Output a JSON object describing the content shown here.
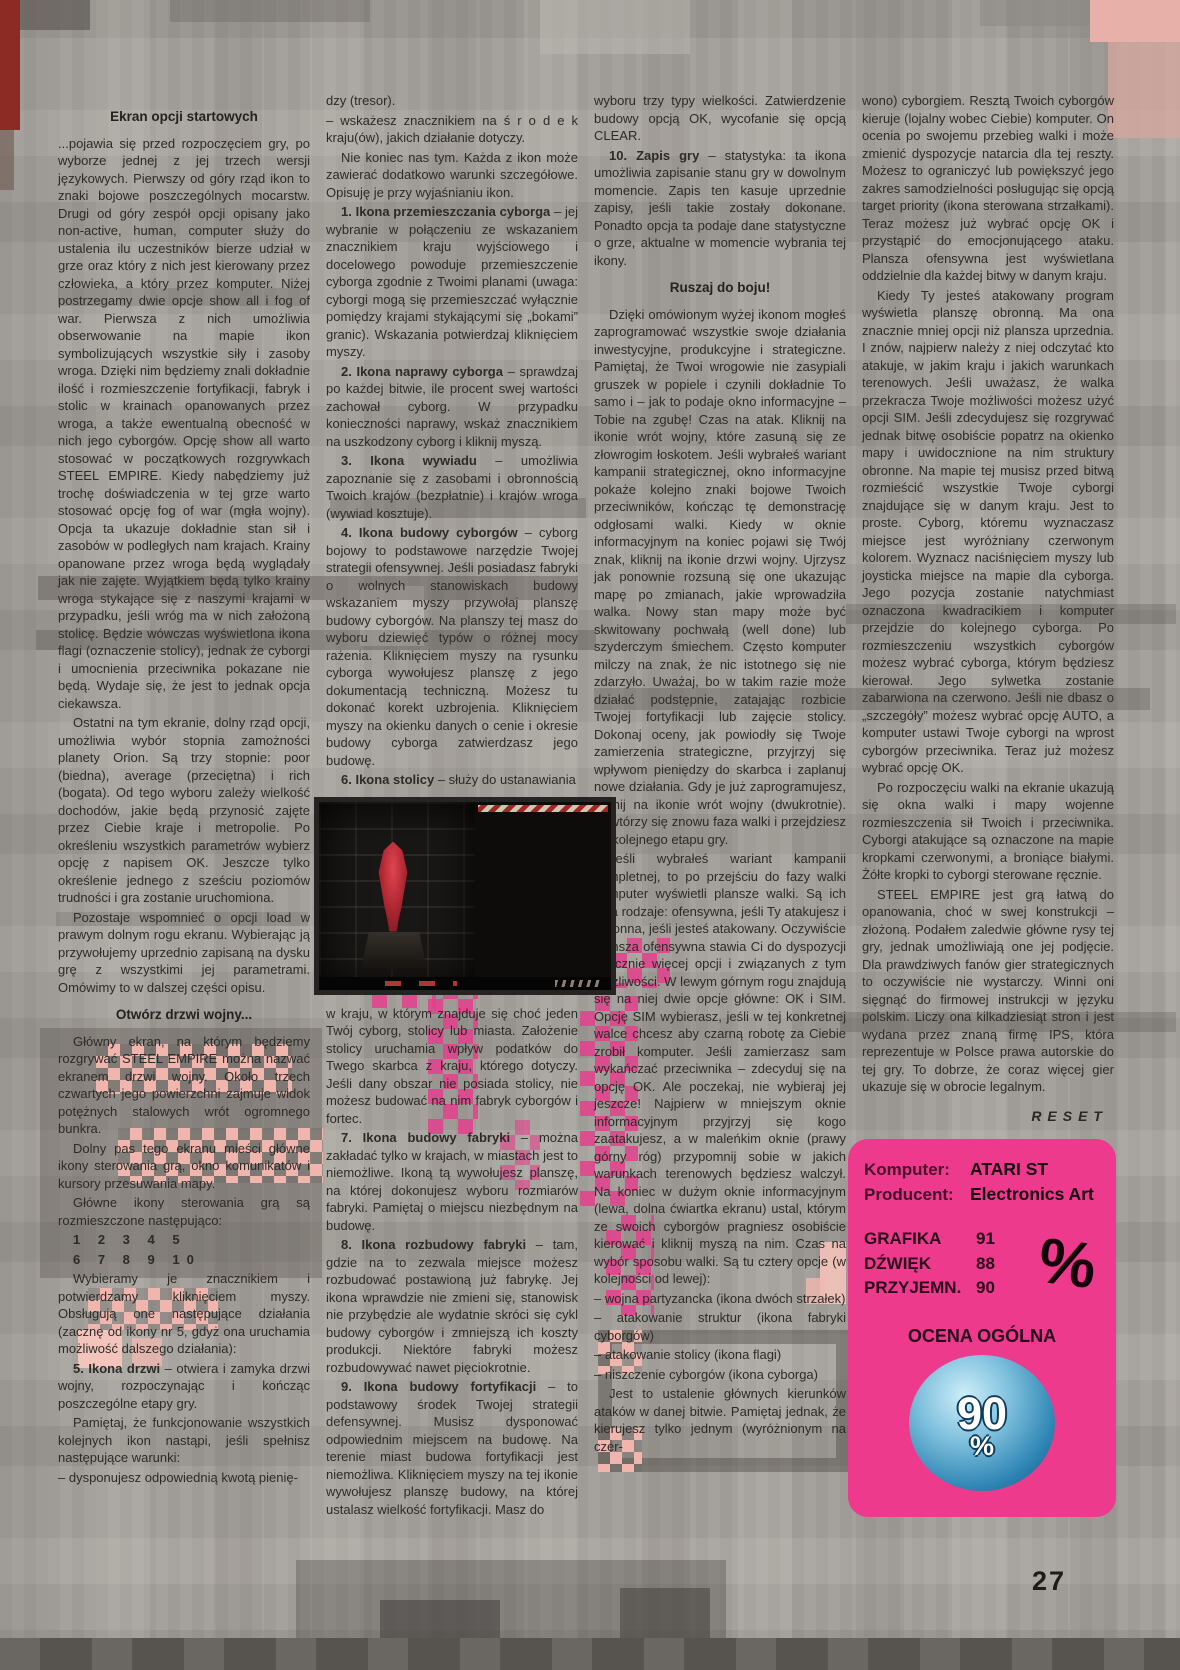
{
  "page": {
    "number": "27"
  },
  "cols": {
    "c1": {
      "heading1": "Ekran opcji startowych",
      "heading2": "Otwórz drzwi wojny...",
      "paras": [
        "...pojawia się przed rozpoczęciem gry, po wyborze jednej z jej trzech wersji językowych. Pierwszy od góry rząd ikon to znaki bojowe poszczególnych mocarstw. Drugi od góry zespół opcji opisany jako non-active, human, computer służy do ustalenia ilu uczestników bierze udział w grze oraz który z nich jest kierowany przez człowieka, a który przez komputer. Niżej postrzegamy dwie opcje show all i fog of war. Pierwsza z nich umożliwia obserwowanie na mapie ikon symbolizujących wszystkie siły i zasoby wroga. Dzięki nim będziemy znali dokładnie ilość i rozmieszczenie fortyfikacji, fabryk i stolic w krainach opanowanych przez wroga, a także ewentualną obecność w nich jego cyborgów. Opcję show all warto stosować w początkowych rozgrywkach STEEL EMPIRE. Kiedy nabędziemy już trochę doświadczenia w tej grze warto stosować opcję fog of war (mgła wojny). Opcja ta ukazuje dokładnie stan sił i zasobów w podległych nam krajach. Krainy opanowane przez wroga będą wyglądały jak nie zajęte. Wyjątkiem będą tylko krainy wroga stykające się z naszymi krajami w przypadku, jeśli wróg ma w nich założoną stolicę. Będzie wówczas wyświetlona ikona flagi (oznaczenie stolicy), jednak że cyborgi i umocnienia przeciwnika pokazane nie będą. Wydaje się, że jest to jednak opcja ciekawsza.",
        "Ostatni na tym ekranie, dolny rząd opcji, umożliwia wybór stopnia zamożności planety Orion. Są trzy stopnie: poor (biedna), average (przeciętna) i rich (bogata). Od tego wyboru zależy wielkość dochodów, jakie będą przynosić zajęte przez Ciebie kraje i metropolie. Po określeniu wszystkich parametrów wybierz opcję z napisem OK. Jeszcze tylko określenie jednego z sześciu poziomów trudności i gra zostanie uruchomiona.",
        "Pozostaje wspomnieć o opcji load w prawym dolnym rogu ekranu. Wybierając ją przywołujemy uprzednio zapisaną na dysku grę z wszystkimi jej parametrami. Omówimy to w dalszej części opisu.",
        "Główny ekran, na którym będziemy rozgrywać STEEL EMPIRE można nazwać ekranem drzwi wojny. Około trzech czwartych jego powierzchni zajmuje widok potężnych stalowych wrót ogromnego bunkra.",
        "Dolny pas tego ekranu mieści główne ikony sterowania grą, okno komunikatów i kursory przesuwania mapy.",
        "Główne ikony sterowania grą są rozmieszczone następująco:",
        "1 2 3 4 5",
        "6 7 8 9 10",
        "Wybieramy je znacznikiem i potwierdzamy kliknięciem myszy. Obsługują one następujące działania (zacznę od ikony nr 5, gdyż ona uruchamia możliwość dalszego działania):",
        {
          "lead": "5. Ikona drzwi",
          "rest": " – otwiera i zamyka drzwi wojny, rozpoczynając i kończąc poszczególne etapy gry."
        },
        "Pamiętaj, że funkcjonowanie wszystkich kolejnych ikon nastąpi, jeśli spełnisz następujące warunki:",
        "– dysponujesz odpowiednią kwotą pienię-"
      ]
    },
    "c2": {
      "paras": [
        "dzy (tresor).",
        "– wskażesz znacznikiem na ś r o d e k kraju(ów), jakich działanie dotyczy.",
        "Nie koniec nas tym. Każda z ikon może zawierać dodatkowo warunki szczegółowe. Opisuję je przy wyjaśnianiu ikon.",
        {
          "lead": "1. Ikona przemieszczania cyborga",
          "rest": " – jej wybranie w połączeniu ze wskazaniem znacznikiem kraju wyjściowego i docelowego powoduje przemieszczenie cyborga zgodnie z Twoimi planami (uwaga: cyborgi mogą się przemieszczać wyłącznie pomiędzy krajami stykającymi się „bokami” granic). Wskazania potwierdzaj kliknięciem myszy."
        },
        {
          "lead": "2. Ikona naprawy cyborga",
          "rest": " – sprawdzaj po każdej bitwie, ile procent swej wartości zachował cyborg. W przypadku konieczności naprawy, wskaż znacznikiem na uszkodzony cyborg i kliknij myszą."
        },
        {
          "lead": "3. Ikona wywiadu",
          "rest": " – umożliwia zapoznanie się z zasobami i obronnością Twoich krajów (bezpłatnie) i krajów wroga (wywiad kosztuje)."
        },
        {
          "lead": "4. Ikona budowy cyborgów",
          "rest": " – cyborg bojowy to podstawowe narzędzie Twojej strategii ofensywnej. Jeśli posiadasz fabryki o wolnych stanowiskach budowy wskazaniem myszy przywołaj planszę budowy cyborgów. Na planszy tej masz do wyboru dziewięć typów o różnej mocy rażenia. Kliknięciem myszy na rysunku cyborga wywołujesz planszę z jego dokumentacją techniczną. Możesz tu dokonać korekt uzbrojenia. Kliknięciem myszy na okienku danych o cenie i okresie budowy cyborga zatwierdzasz jego budowę."
        },
        {
          "lead": "6. Ikona stolicy",
          "rest": " – służy do ustanawiania"
        },
        "w kraju, w którym znajduje się choć jeden Twój cyborg, stolicy lub miasta. Założenie stolicy uruchamia wpływ podatków do Twego skarbca z kraju, którego dotyczy. Jeśli dany obszar nie posiada stolicy, nie możesz budować na nim fabryk cyborgów i fortec.",
        {
          "lead": "7. Ikona budowy fabryki",
          "rest": " – można zakładać tylko w krajach, w miastach jest to niemożliwe. Ikoną tą wywołujesz planszę, na której dokonujesz wyboru rozmiarów fabryki. Pamiętaj o miejscu niezbędnym na budowę."
        },
        {
          "lead": "8. Ikona rozbudowy fabryki",
          "rest": " – tam, gdzie na to zezwala miejsce możesz rozbudować postawioną już fabrykę. Jej ikona wprawdzie nie zmieni się, stanowisk nie przybędzie ale wydatnie skróci się cykl budowy cyborgów i zmniejszą ich koszty produkcji. Niektóre fabryki możesz rozbudowywać nawet pięciokrotnie."
        },
        {
          "lead": "9. Ikona budowy fortyfikacji",
          "rest": " – to podstawowy środek Twojej strategii defensywnej. Musisz dysponować odpowiednim miejscem na budowę. Na terenie miast budowa fortyfikacji jest niemożliwa. Kliknięciem myszy na tej ikonie wywołujesz planszę budowy, na której ustalasz wielkość fortyfikacji. Masz do"
        }
      ]
    },
    "c3": {
      "heading": "Ruszaj do boju!",
      "paras": [
        "wyboru trzy typy wielkości. Zatwierdzenie budowy opcją OK, wycofanie się opcją CLEAR.",
        {
          "lead": "10. Zapis gry",
          "rest": " – statystyka: ta ikona umożliwia zapisanie stanu gry w dowolnym momencie. Zapis ten kasuje uprzednie zapisy, jeśli takie zostały dokonane. Ponadto opcja ta podaje dane statystyczne o grze, aktualne w momencie wybrania tej ikony."
        },
        "Dzięki omówionym wyżej ikonom mogłeś zaprogramować wszystkie swoje działania inwestycyjne, produkcyjne i strategiczne. Pamiętaj, że Twoi wrogowie nie zasypiali gruszek w popiele i czynili dokładnie To samo i – jak to podaje okno informacyjne – Tobie na zgubę! Czas na atak. Kliknij na ikonie wrót wojny, które zasuną się ze złowrogim łoskotem. Jeśli wybrałeś wariant kampanii strategicznej, okno informacyjne pokaże kolejno znaki bojowe Twoich przeciwników, kończąc tę demonstrację odgłosami walki. Kiedy w oknie informacyjnym na koniec pojawi się Twój znak, kliknij na ikonie drzwi wojny. Ujrzysz jak ponownie rozsuną się one ukazując mapę po zmianach, jakie wprowadziła walka. Nowy stan mapy może być skwitowany pochwałą (well done) lub szyderczym śmiechem. Często komputer milczy na znak, że nic istotnego się nie zdarzyło. Uważaj, bo w takim razie może działać podstępnie, zatajając rozbicie Twojej fortyfikacji lub zajęcie stolicy. Dokonaj oceny, jak powiodły się Twoje zamierzenia strategiczne, przyjrzyj się wpływom pieniędzy do skarbca i zaplanuj nowe działania. Gdy je już zaprogramujesz, kliknij na ikonie wrót wojny (dwukrotnie). Powtórzy się znowu faza walki i przejdziesz do kolejnego etapu gry.",
        "Jeśli wybrałeś wariant kampanii kompletnej, to po przejściu do fazy walki komputer wyświetli plansze walki. Są ich dwa rodzaje: ofensywna, jeśli Ty atakujesz i obronna, jeśli jesteś atakowany. Oczywiście plansza ofensywna stawia Ci do dyspozycji znacznie więcej opcji i związanych z tym możliwości. W lewym górnym rogu znajdują się na niej dwie opcje główne: OK i SIM. Opcję SIM wybierasz, jeśli w tej konkretnej walce chcesz aby czarną robotę za Ciebie zrobił komputer. Jeśli zamierzasz sam wykańczać przeciwnika – zdecyduj się na opcję OK. Ale poczekaj, nie wybieraj jej jeszcze! Najpierw w mniejszym oknie informacyjnym przyjrzyj się kogo zaatakujesz, a w maleńkim oknie (prawy górny róg) przypomnij sobie w jakich warunkach terenowych będziesz walczył. Na koniec w dużym oknie informacyjnym (lewa, dolna ćwiartka ekranu) ustal, którym ze swoich cyborgów pragniesz osobiście kierować i kliknij myszą na nim. Czas na wybór sposobu walki. Są tu cztery opcje (w kolejności od lewej):",
        "– wojna partyzancka (ikona dwóch strzałek)",
        "– atakowanie struktur (ikona fabryki cyborgów)",
        "– atakowanie stolicy (ikona flagi)",
        "– niszczenie cyborgów (ikona cyborga)",
        "Jest to ustalenie głównych kierunków ataków w danej bitwie. Pamiętaj jednak, że kierujesz tylko jednym (wyróżnionym na czer-"
      ]
    },
    "c4": {
      "signature": "RESET",
      "paras": [
        "wono) cyborgiem. Resztą Twoich cyborgów kieruje (lojalny wobec Ciebie) komputer. On ocenia po swojemu przebieg walki i może zmienić dyspozycje natarcia dla tej reszty. Możesz to ograniczyć lub powiększyć jego zakres samodzielności posługując się opcją target priority (ikona sterowana strzałkami). Teraz możesz już wybrać opcję OK i przystąpić do emocjonującego ataku. Plansza ofensywna jest wyświetlana oddzielnie dla każdej bitwy w danym kraju.",
        "Kiedy Ty jesteś atakowany program wyświetla planszę obronną. Ma ona znacznie mniej opcji niż plansza uprzednia. I znów, najpierw należy z niej odczytać kto atakuje, w jakim kraju i jakich warunkach terenowych. Jeśli uważasz, że walka przekracza Twoje możliwości możesz użyć opcji SIM. Jeśli zdecydujesz się rozgrywać jednak bitwę osobiście popatrz na okienko mapy i uwidocznione na nim struktury obronne. Na mapie tej musisz przed bitwą rozmieścić wszystkie Twoje cyborgi znajdujące się w danym kraju. Jest to proste. Cyborg, któremu wyznaczasz miejsce jest wyróżniany czerwonym kolorem. Wyznacz naciśnięciem myszy lub joysticka miejsce na mapie dla cyborga. Jego pozycja zostanie natychmiast oznaczona kwadracikiem i komputer przejdzie do kolejnego cyborga. Po rozmieszczeniu wszystkich cyborgów możesz wybrać cyborga, którym będziesz kierował. Jego sylwetka zostanie zabarwiona na czerwono. Jeśli nie dbasz o „szczegóły” możesz wybrać opcję AUTO, a komputer ustawi Twoje cyborgi na wprost cyborgów przeciwnika. Teraz już możesz wybrać opcję OK.",
        "Po rozpoczęciu walki na ekranie ukazują się okna walki i mapy wojenne rozmieszczenia sił Twoich i przeciwnika. Cyborgi atakujące są oznaczone na mapie kropkami czerwonymi, a broniące białymi. Żółte kropki to cyborgi sterowane ręcznie.",
        "STEEL EMPIRE jest grą łatwą do opanowania, choć w swej konstrukcji – złożoną. Podałem zaledwie główne rysy tej gry, jednak umożliwiają one jej podjęcie. Dla prawdziwych fanów gier strategicznych to oczywiście nie wystarczy. Winni oni sięgnąć do firmowej instrukcji w języku polskim. Liczy ona kilkadziesiąt stron i jest wydana przez znaną firmę IPS, która reprezentuje w Polsce prawa autorskie do tej gry. To dobrze, że coraz więcej gier ukazuje się w obrocie legalnym."
      ]
    }
  },
  "review": {
    "computer_label": "Komputer:",
    "computer_value": "ATARI ST",
    "producer_label": "Producent:",
    "producer_value": "Electronics Art",
    "ratings": [
      {
        "label": "GRAFIKA",
        "value": "91"
      },
      {
        "label": "DŹWIĘK",
        "value": "88"
      },
      {
        "label": "PRZYJEMN.",
        "value": "90"
      }
    ],
    "percent_glyph": "%",
    "overall_label": "OCENA OGÓLNA",
    "overall_value": "90",
    "overall_unit": "%",
    "colors": {
      "box_pink": "#ee3a8c",
      "ball_blue": "#2f86b5",
      "magenta_accent": "#e43f8c",
      "salmon_accent": "#f0b6ad"
    }
  }
}
